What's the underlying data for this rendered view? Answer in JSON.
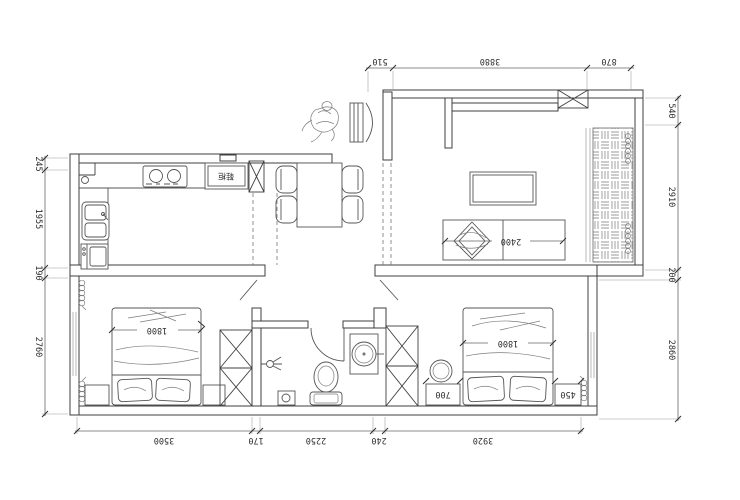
{
  "drawing": {
    "type": "apartment floor plan",
    "unit": "mm"
  },
  "dimensions": {
    "top": [
      "510",
      "3880",
      "870"
    ],
    "right": [
      "540",
      "2910",
      "200",
      "2860"
    ],
    "left": [
      "245",
      "1955",
      "190",
      "2760"
    ],
    "bottom": [
      "3500",
      "170",
      "2250",
      "240",
      "3920"
    ]
  },
  "labels": {
    "sofa_width": "2400",
    "left_bed_width": "1800",
    "right_bed_width": "1800",
    "right_nightstand_width": "700",
    "right_bedside_width": "450",
    "cabinet": "鞋柜"
  },
  "colors": {
    "background": "#ffffff",
    "line": "#3f3f3f",
    "text": "#2e2e2e"
  }
}
